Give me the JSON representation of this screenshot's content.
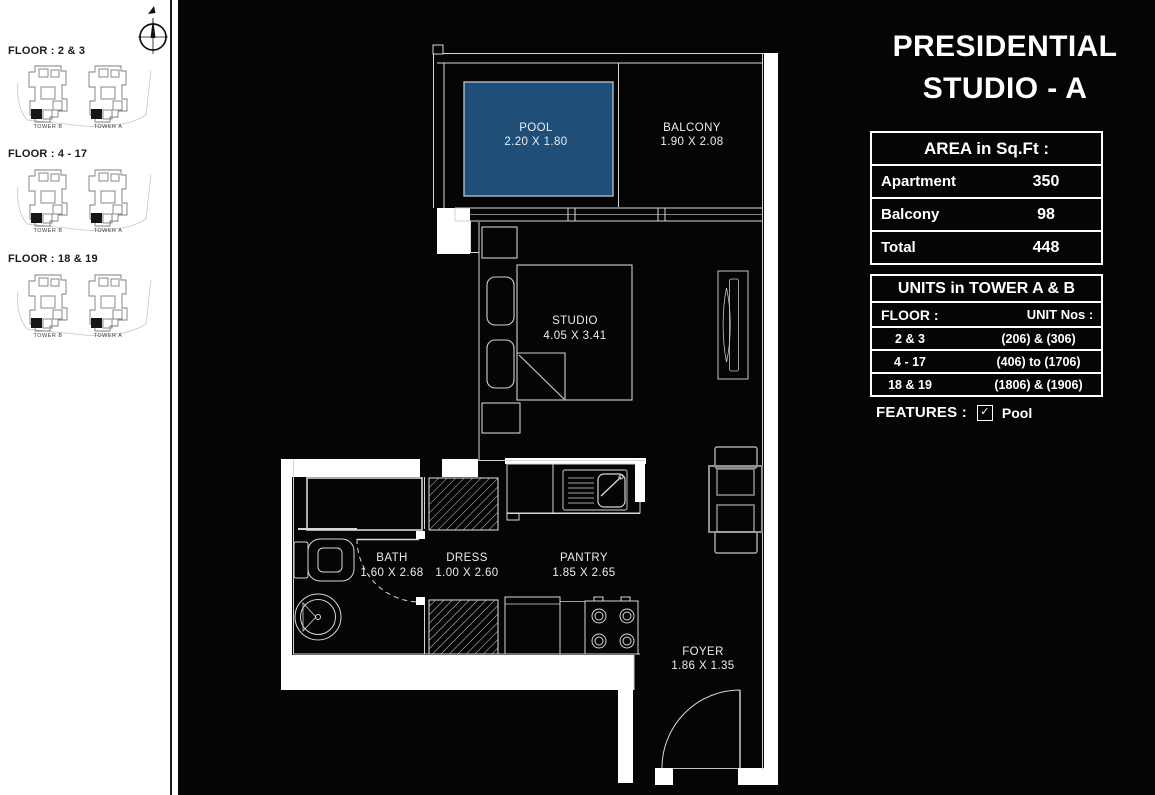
{
  "title": {
    "line1": "PRESIDENTIAL",
    "line2": "STUDIO - A"
  },
  "sidebar": {
    "sections": [
      {
        "floor_label": "FLOOR : 2 & 3",
        "tower_left": "TOWER B",
        "tower_right": "TOWER A"
      },
      {
        "floor_label": "FLOOR : 4 - 17",
        "tower_left": "TOWER B",
        "tower_right": "TOWER A"
      },
      {
        "floor_label": "FLOOR : 18 & 19",
        "tower_left": "TOWER B",
        "tower_right": "TOWER A"
      }
    ]
  },
  "area_table": {
    "header": "AREA in Sq.Ft :",
    "rows": [
      {
        "label": "Apartment",
        "value": "350"
      },
      {
        "label": "Balcony",
        "value": "98"
      },
      {
        "label": "Total",
        "value": "448"
      }
    ]
  },
  "units_table": {
    "header": "UNITS in TOWER A & B",
    "col_floor": "FLOOR :",
    "col_units": "UNIT Nos :",
    "rows": [
      {
        "floor": "2 & 3",
        "units": "(206) & (306)"
      },
      {
        "floor": "4 - 17",
        "units": "(406) to (1706)"
      },
      {
        "floor": "18 & 19",
        "units": "(1806) & (1906)"
      }
    ]
  },
  "features": {
    "label": "FEATURES :",
    "check_glyph": "✓",
    "items": [
      {
        "name": "Pool",
        "checked": true
      }
    ]
  },
  "rooms": {
    "pool": {
      "name": "POOL",
      "dims": "2.20 X 1.80"
    },
    "balcony": {
      "name": "BALCONY",
      "dims": "1.90 X 2.08"
    },
    "studio": {
      "name": "STUDIO",
      "dims": "4.05 X 3.41"
    },
    "bath": {
      "name": "BATH",
      "dims": "1.60 X 2.68"
    },
    "dress": {
      "name": "DRESS",
      "dims": "1.00 X 2.60"
    },
    "pantry": {
      "name": "PANTRY",
      "dims": "1.85 X 2.65"
    },
    "foyer": {
      "name": "FOYER",
      "dims": "1.86 X 1.35"
    }
  },
  "colors": {
    "pool_fill": "#1F4E79",
    "plan_line": "#D6D6D6",
    "wall_fill": "#FFFFFF",
    "canvas": "#050505",
    "page": "#FFFFFF"
  }
}
